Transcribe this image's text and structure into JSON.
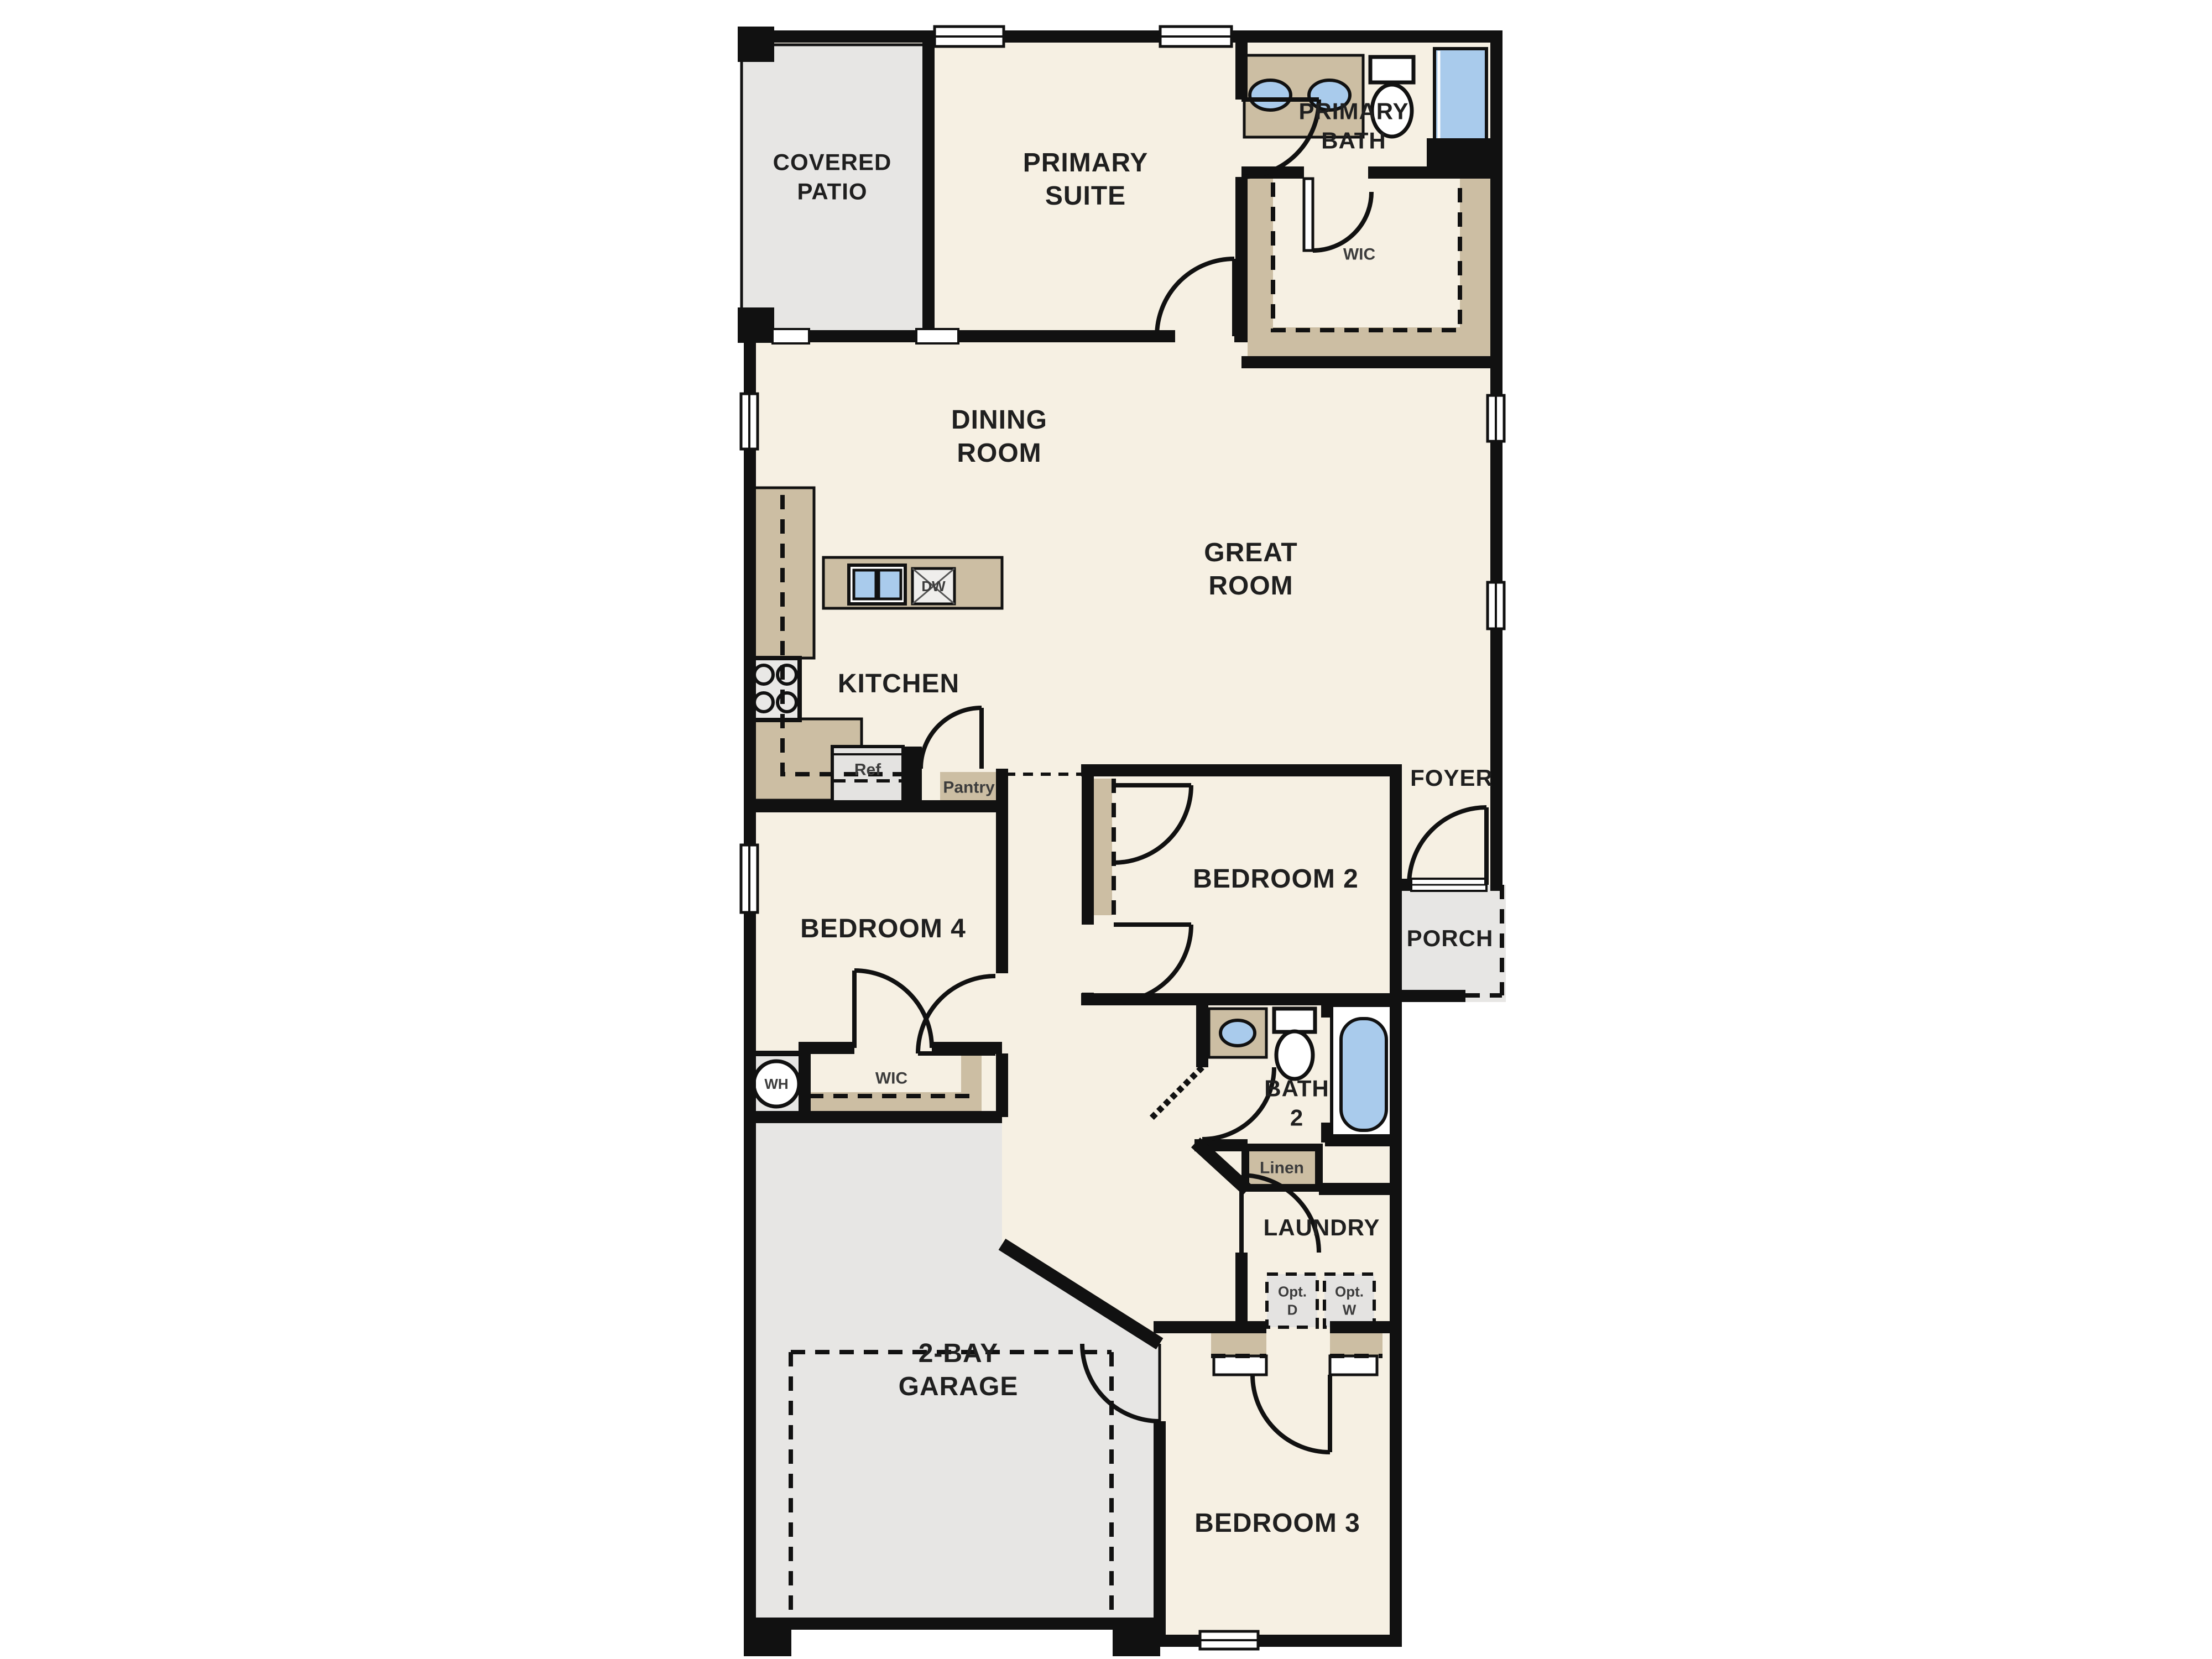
{
  "plan": {
    "type": "single-story residential floor plan",
    "colors": {
      "wall": "#111111",
      "room_fill": "#f6f0e3",
      "outdoor_fill": "#e7e6e4",
      "cabinet_tan": "#ccbea3",
      "fixture_blue": "#a9cbec",
      "appliance_gray": "#e4e3e1",
      "label_text": "#1f1f1f",
      "small_label_text": "#3c3c3c"
    },
    "labels": {
      "covered_patio": "COVERED\nPATIO",
      "primary_suite": "PRIMARY\nSUITE",
      "primary_bath": "PRIMARY\nBATH",
      "wic_primary": "WIC",
      "dining_room": "DINING\nROOM",
      "great_room": "GREAT\nROOM",
      "kitchen": "KITCHEN",
      "dishwasher": "DW",
      "refrigerator": "Ref",
      "pantry": "Pantry",
      "foyer": "FOYER",
      "bedroom2": "BEDROOM 2",
      "porch": "PORCH",
      "bedroom4": "BEDROOM 4",
      "wic_bedroom4": "WIC",
      "water_heater": "WH",
      "bath2": "BATH\n2",
      "linen": "Linen",
      "laundry": "LAUNDRY",
      "opt_dryer": "Opt.\nD",
      "opt_washer": "Opt.\nW",
      "garage": "2-BAY\nGARAGE",
      "bedroom3": "BEDROOM 3"
    },
    "fixtures": [
      "double-sink-vanity-icon",
      "toilet-icon",
      "shower-icon",
      "bathtub-icon",
      "kitchen-sink-icon",
      "dishwasher-icon",
      "stove-icon",
      "refrigerator-icon",
      "water-heater-icon",
      "optional-dryer-icon",
      "optional-washer-icon"
    ]
  }
}
